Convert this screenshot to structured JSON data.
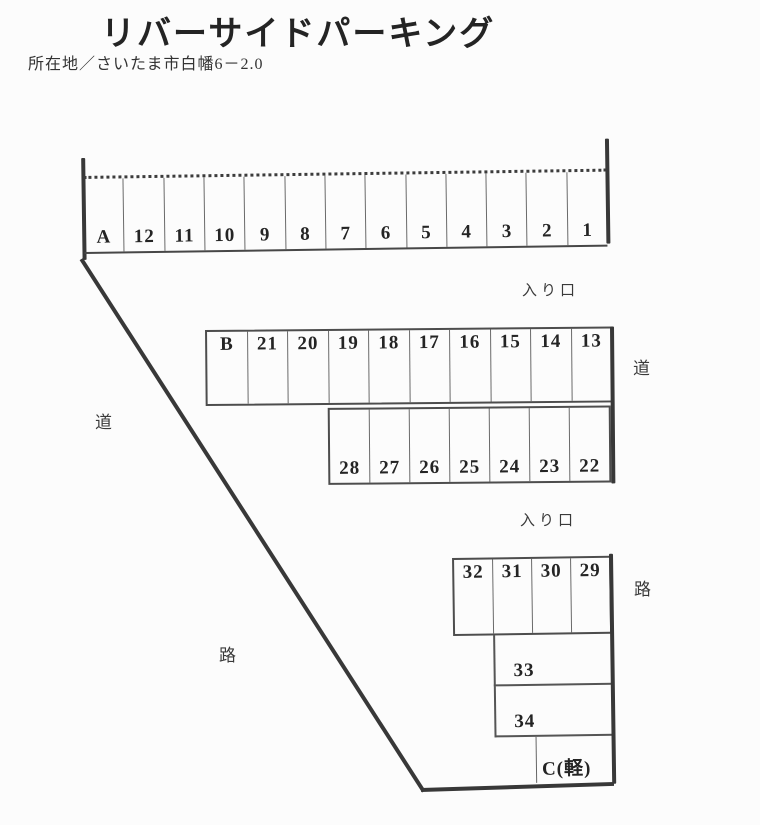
{
  "header": {
    "title": "リバーサイドパーキング",
    "address": "所在地／さいたま市白幡6－2.0"
  },
  "lot": {
    "top_row": [
      "A",
      "12",
      "11",
      "10",
      "9",
      "8",
      "7",
      "6",
      "5",
      "4",
      "3",
      "2",
      "1"
    ],
    "mid_row_upper": [
      "B",
      "21",
      "20",
      "19",
      "18",
      "17",
      "16",
      "15",
      "14",
      "13"
    ],
    "mid_row_lower": [
      "28",
      "27",
      "26",
      "25",
      "24",
      "23",
      "22"
    ],
    "bottom_row": [
      "32",
      "31",
      "30",
      "29"
    ],
    "stall_33": "33",
    "stall_34": "34",
    "stall_c": "C(軽)"
  },
  "labels": {
    "entrance_upper": "入り口",
    "entrance_lower": "入り口",
    "road_right_upper": "道",
    "road_left_upper": "道",
    "road_right_lower": "路",
    "road_left_lower": "路"
  },
  "colors": {
    "line": "#383838",
    "text": "#262626",
    "background": "#fcfcfc"
  }
}
